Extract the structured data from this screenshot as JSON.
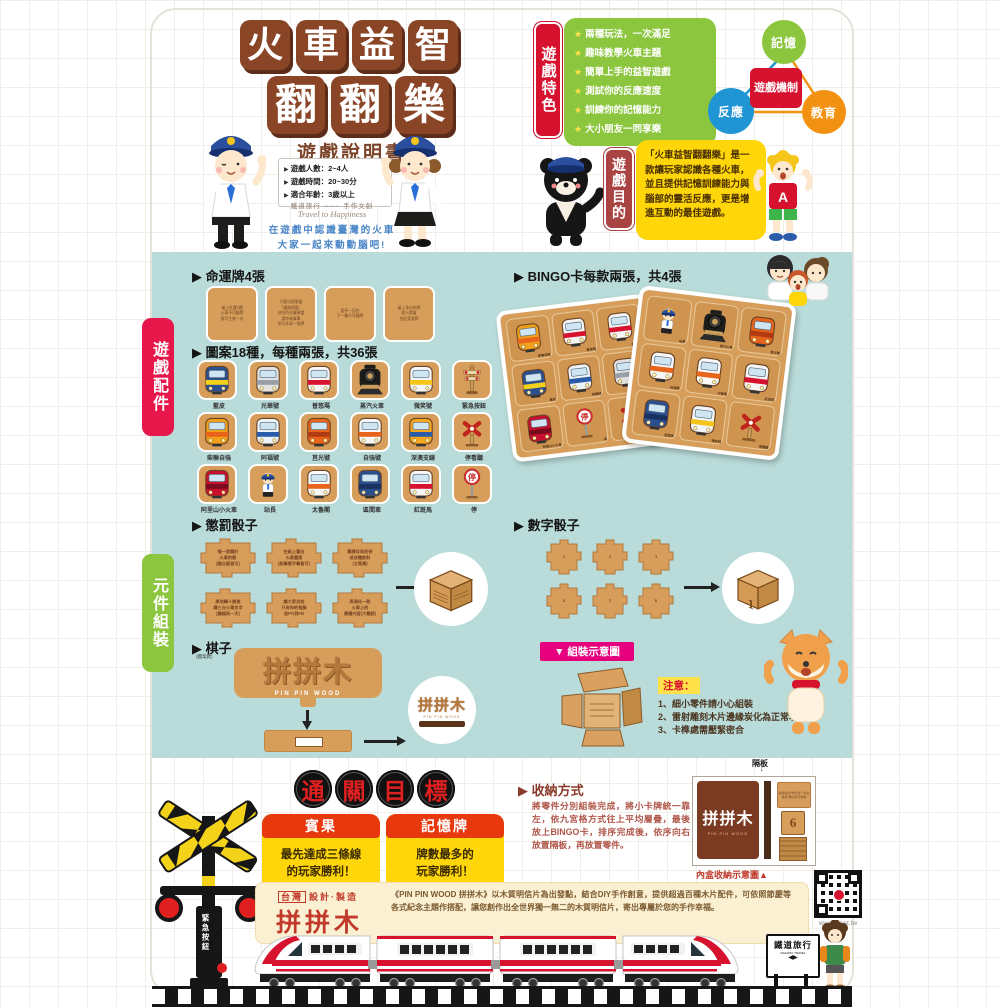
{
  "header": {
    "marker": "▶",
    "title_row1": [
      "火",
      "車",
      "益",
      "智"
    ],
    "title_row2": [
      "翻",
      "翻",
      "樂"
    ],
    "subtitle": "遊戲說明書",
    "info_items": [
      "遊戲人數：2~4人",
      "遊戲時間：20~30分",
      "適合年齡：3歲以上"
    ],
    "brand_line": "鐵道旅行 ─── 手作文創",
    "brand_en": "Travel to Happiness",
    "tagline1": "在遊戲中認識臺灣的火車",
    "tagline2": "大家一起來動動腦吧!"
  },
  "features": {
    "tab": "遊戲特色",
    "star": "★",
    "items": [
      "兩種玩法，一次滿足",
      "趣味教學火車主題",
      "簡單上手的益智遊戲",
      "測試你的反應速度",
      "訓練你的記憶能力",
      "大小朋友一同享樂"
    ]
  },
  "mechanism": {
    "center": "遊戲機制",
    "nodes": [
      {
        "label": "記憶",
        "color": "#8cc63e"
      },
      {
        "label": "反應",
        "color": "#2095d3"
      },
      {
        "label": "教育",
        "color": "#f39212"
      }
    ]
  },
  "purpose": {
    "tab": "遊戲目的",
    "kid_letter": "A",
    "text": "「火車益智翻翻樂」是一款讓玩家認識各種火車，並且提供記憶訓練能力與腦部的靈活反應，更是增進互動的最佳遊戲。"
  },
  "components": {
    "tab": "遊戲配件",
    "fate_title": "▶ 命運牌4張",
    "fate_cards": [
      [
        "桌上任選1種",
        "火車不可翻牌",
        "即可生效一次"
      ],
      [
        "只要出現便當",
        "「鐵路便當」",
        "好吃的台鐵便當",
        "請你來買單",
        "即可多拿一張牌"
      ],
      [
        "暫停一回合",
        "下一輪不可翻牌"
      ],
      [
        "桌上多出的牌",
        "放入牌盒",
        "由莊家發牌"
      ]
    ],
    "bingo_title": "▶ BINGO卡每款兩張，共4張",
    "pattern_title": "▶ 圖案18種，每種兩張，共36張",
    "cards": [
      {
        "label": "藍皮",
        "icon": "train",
        "c1": "#2a4f8f",
        "c2": "#f5d21a"
      },
      {
        "label": "光華號",
        "icon": "train",
        "c1": "#e2e2e2",
        "c2": "#9aa0a8"
      },
      {
        "label": "普悠瑪",
        "icon": "train",
        "c1": "#f5f5f5",
        "c2": "#d7122e"
      },
      {
        "label": "蒸汽火車",
        "icon": "steam",
        "c1": "#1d1d1b",
        "c2": "#444444"
      },
      {
        "label": "微笑號",
        "icon": "train",
        "c1": "#f2f6fa",
        "c2": "#f5c51a"
      },
      {
        "label": "緊急按鈕",
        "icon": "semaphore",
        "c1": "#caa05c",
        "c2": "#d7122e"
      },
      {
        "label": "柴聯自強",
        "icon": "train",
        "c1": "#f0a01a",
        "c2": "#e8641a"
      },
      {
        "label": "阿福號",
        "icon": "train",
        "c1": "#eef3f8",
        "c2": "#2a5caa"
      },
      {
        "label": "莒光號",
        "icon": "train",
        "c1": "#e8641a",
        "c2": "#b03a12"
      },
      {
        "label": "自強號",
        "icon": "train",
        "c1": "#f7f7f7",
        "c2": "#e8641a"
      },
      {
        "label": "深澳支線",
        "icon": "train",
        "c1": "#f5a81c",
        "c2": "#2a5caa"
      },
      {
        "label": "停看聽",
        "icon": "crossing",
        "c1": "#c0251c",
        "c2": "#caa05c"
      },
      {
        "label": "阿里山小火車",
        "icon": "train",
        "c1": "#c8102e",
        "c2": "#7a0a1e"
      },
      {
        "label": "站長",
        "icon": "person",
        "c1": "#2a4f9e",
        "c2": "#ffffff"
      },
      {
        "label": "太魯閣",
        "icon": "train",
        "c1": "#fafafa",
        "c2": "#e8641a"
      },
      {
        "label": "區間車",
        "icon": "train",
        "c1": "#2a4f8f",
        "c2": "#1a3060"
      },
      {
        "label": "紅斑馬",
        "icon": "train",
        "c1": "#f5f5f5",
        "c2": "#d7122e"
      },
      {
        "label": "停",
        "icon": "stop",
        "c1": "#c9302c",
        "c2": "#9a9a9a"
      }
    ],
    "bingoA": [
      6,
      2,
      16,
      0,
      7,
      1,
      12,
      17,
      11
    ],
    "bingoB": [
      13,
      3,
      8,
      9,
      14,
      16,
      15,
      4,
      11
    ]
  },
  "assembly": {
    "tab": "元件組裝",
    "punish_title": "▶ 懲罰骰子",
    "punish_faces": [
      [
        "唱一首關於",
        "火車的歌",
        "(國台語皆可)"
      ],
      [
        "在紙上畫出",
        "火車圖案",
        "(鉛筆簽字筆皆可)"
      ],
      [
        "購買珍珠奶茶",
        "或含糖飲料",
        "(立馬買)"
      ],
      [
        "原地轉十圈後",
        "講三台火車名字",
        "(講錯再一次)"
      ],
      [
        "讓大家自拍",
        "只有你的鬼臉",
        "並PO到FB"
      ],
      [
        "表演任一款",
        "火車上的",
        "廣播內容(大聲說)"
      ]
    ],
    "number_title": "▶ 數字骰子",
    "numbers": [
      "1",
      "2",
      "3",
      "4",
      "5",
      "6"
    ],
    "cube_numbers": {
      "front": "1",
      "side": "6",
      "top": "3"
    },
    "piece_title": "▶ 棋子",
    "piece_note": "(圖案款)",
    "logo": "拼拼木",
    "logo_en": "PIN PIN WOOD",
    "diagram_label": "▼ 組裝示意圖",
    "notice_title": "注意：",
    "notices": [
      "1、細小零件請小心組裝",
      "2、雷射雕刻木片邊緣炭化為正常現象",
      "3、卡榫處需壓緊密合"
    ]
  },
  "goal": {
    "chars": [
      "通",
      "關",
      "目",
      "標"
    ],
    "cards": [
      {
        "header": "賓果",
        "line1": "最先達成三條線",
        "line2": "的玩家勝利！",
        "stamp": "勝"
      },
      {
        "header": "記憶牌",
        "line1": "牌數最多的",
        "line2": "玩家勝利！",
        "stamp": "勝"
      }
    ]
  },
  "storage": {
    "title": "▶ 收納方式",
    "text": "將零件分別組裝完成，將小卡牌統一靠左，依九宮格方式往上平均層疊，最後放上BINGO卡，排序完成後，依序向右放置隔板，再放置零件。",
    "divider": "隔板",
    "arrow": "↓",
    "box_logo": "拼拼木",
    "box_logo_en": "PIN PIN WOOD",
    "inner_note": "組合好的卡牌 統一靠左放置 疊好即可收納",
    "die_face": "6",
    "caption": "內盒收納示意圖▲"
  },
  "footer": {
    "made_in_box": "台灣",
    "made_in": "設計·製造",
    "logo": "拼拼木",
    "logo_en": "PIN PIN WOOD",
    "desc": "《PIN PIN WOOD 拼拼木》以木質明信片為出發點，結合DIY手作創意，提供超過百種木片配件，可依照節慶等各式紀念主題作搭配，讓您創作出全世界獨一無二的木質明信片，寄出專屬於您的手作幸福。",
    "url": "www.tr.net.tw",
    "sign": "鐵道旅行",
    "sign_en": "RAILWAY TRAVEL",
    "sign_arrows": "◀▶",
    "emergency": "緊急按鈕"
  }
}
